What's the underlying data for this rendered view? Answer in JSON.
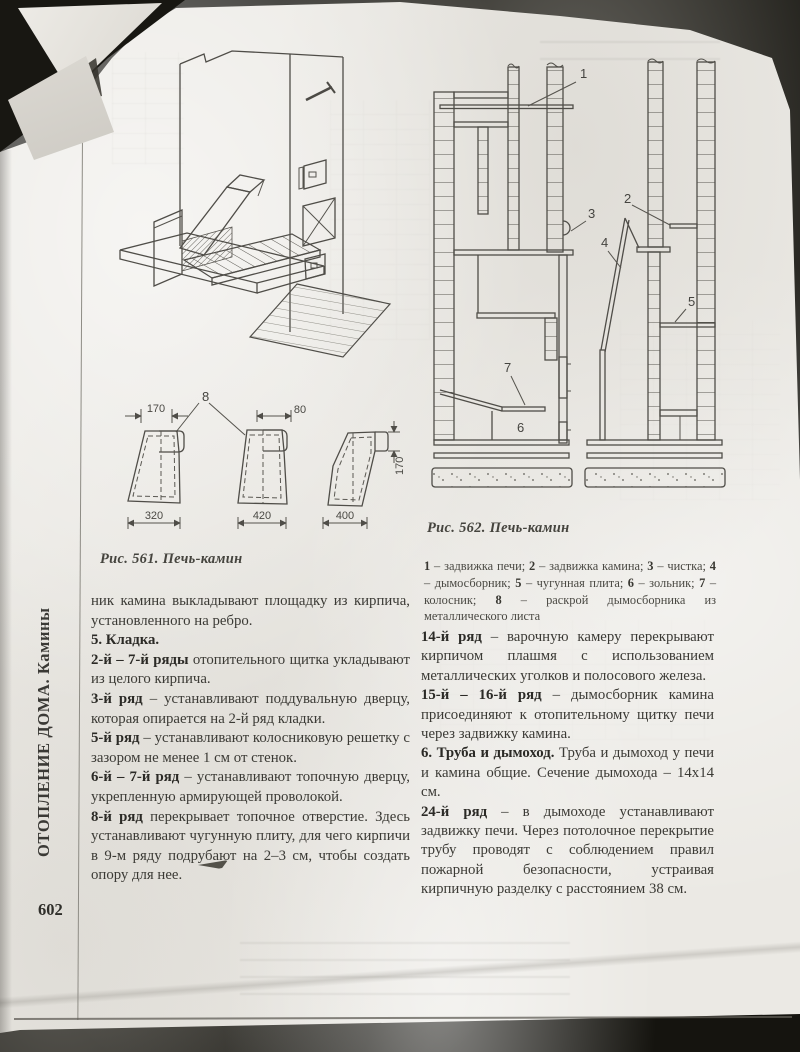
{
  "page": {
    "margin_title": "ОТОПЛЕНИЕ ДОМА. Камины",
    "number": "602"
  },
  "fig561": {
    "caption": "Рис. 561. Печь-камин"
  },
  "fig_patterns": {
    "callout": "8",
    "dims": {
      "w170": "170",
      "w80": "80",
      "w320": "320",
      "w420": "420",
      "w400": "400",
      "h170": "170"
    }
  },
  "fig562": {
    "caption": "Рис. 562. Печь-камин",
    "callouts": [
      "1",
      "2",
      "3",
      "4",
      "5",
      "6",
      "7"
    ],
    "legend": [
      {
        "n": "1",
        "t": " – задвижка печи; "
      },
      {
        "n": "2",
        "t": " – задвижка камина; "
      },
      {
        "n": "3",
        "t": " – чистка; "
      },
      {
        "n": "4",
        "t": " – дымосборник; "
      },
      {
        "n": "5",
        "t": " – чугунная плита; "
      },
      {
        "n": "6",
        "t": " – зольник; "
      },
      {
        "n": "7",
        "t": " – колосник; "
      },
      {
        "n": "8",
        "t": " – раскрой дымосборника из металлического листа"
      }
    ]
  },
  "left_column": {
    "paragraphs": [
      {
        "lead": "",
        "rest": "ник камина выкладывают площадку из кирпича, установленного на ребро."
      },
      {
        "lead": "5. Кладка.",
        "rest": ""
      },
      {
        "lead": "2-й – 7-й ряды",
        "rest": " отопительного щитка укладывают из целого кирпича."
      },
      {
        "lead": "3-й ряд",
        "rest": " – устанавливают поддувальную дверцу, которая опирается на 2-й ряд кладки."
      },
      {
        "lead": "5-й ряд",
        "rest": " – устанавливают колосниковую решетку с зазором не менее 1 см от стенок."
      },
      {
        "lead": "6-й – 7-й ряд",
        "rest": " – устанавливают топочную дверцу, укрепленную армирующей проволокой."
      },
      {
        "lead": "8-й ряд",
        "rest": " перекрывает топочное отверстие. Здесь устанавливают чугунную плиту, для чего кирпичи в 9-м ряду подрубают на 2–3 см, чтобы создать опору для нее."
      }
    ]
  },
  "right_column": {
    "paragraphs": [
      {
        "lead": "14-й ряд",
        "rest": " – варочную камеру перекрывают кирпичом плашмя с использованием металлических уголков и полосового железа."
      },
      {
        "lead": "15-й – 16-й ряд",
        "rest": " – дымосборник камина присоединяют к отопительному щитку печи через задвижку камина."
      },
      {
        "lead": "6. Труба и дымоход.",
        "rest": " Труба и дымоход у печи и камина общие. Сечение дымохода – 14х14 см."
      },
      {
        "lead": "24-й ряд",
        "rest": " – в дымоходе устанавливают задвижку печи. Через потолочное перекрытие трубу проводят с соблюдением правил пожарной безопасности, устраивая кирпичную разделку с расстоянием 38 см."
      }
    ]
  }
}
